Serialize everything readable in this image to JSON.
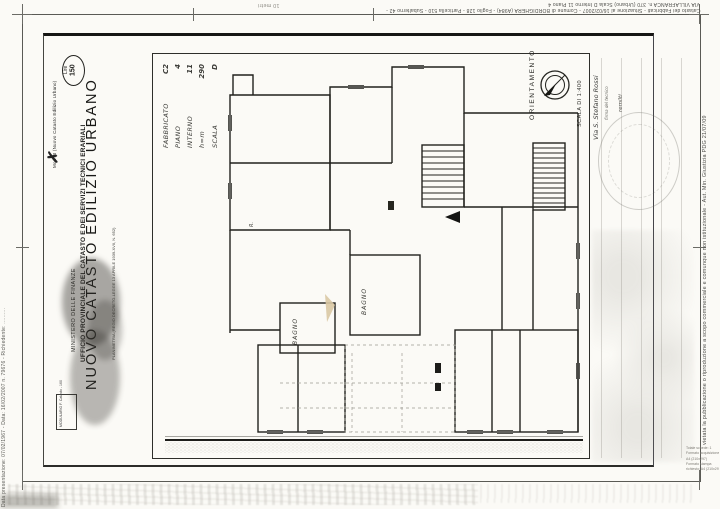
{
  "colors": {
    "paper": "#fbfaf6",
    "ink": "#1d1d1b",
    "faint_gray": "#9a968c",
    "artifact_tan": "#d9c8a4"
  },
  "edge_watermarks": {
    "top_line1": "VIA VILLAFRANCA n. 370 (Urbano) Scala D Interno 11 Piano 4",
    "top_line2": "Catasto dei Fabbricati - Situazione al 16/02/2007 - Comune di BORDIGHERA (A984) - Foglio 128 - Particella 510 - Subalterno 42 -",
    "top_scale_note": "10 metri",
    "left_edge": "Data presentazione: 07/02/1967 - Data: 16/02/2007 n. 79676 - Richiedente: ..........",
    "right_edge": "vietata la pubblicazione o riproduzione a scopo commerciale e comunque non istituzionale - Aut. Min. Giustizia PDG 21/07/09",
    "corner_lines": [
      "Totale schede: 1",
      "Formato acquisizione:",
      "A4 (210x297)",
      "Formato stampa",
      "richiesto: A4 (210x297)"
    ]
  },
  "form": {
    "annotation_x": "✗",
    "mod_note": "Mod. B (Nuovo Catasto Edilizio Urbano)",
    "stamp_currency": "Lire",
    "stamp_value": "150",
    "header_ministry": "MINISTERO DELLE FINANZE",
    "header_office": "UFFICIO PROVINCIALE DEL CATASTO E DEI SERVIZI TECNICI ERARIALI",
    "header_title": "NUOVO CATASTO EDILIZIO URBANO",
    "header_law": "PLANIMETRIA (REGIO DECRETO-LEGGE 13 APRILE 1939-XVII, N. 652)",
    "modulario_line1": "MODULARIO",
    "modulario_line2": "F. Catasto - 160",
    "fields": [
      {
        "label": "FABBRICATO",
        "value": "C2"
      },
      {
        "label": "PIANO",
        "value": "4"
      },
      {
        "label": "INTERNO",
        "value": "11"
      },
      {
        "label": "h=m",
        "value": "290"
      },
      {
        "label": "SCALA",
        "value": "D"
      }
    ],
    "orientation_label": "ORIENTAMENTO",
    "scale_label": "SCALA DI 1:400",
    "handwritten_street": "Via S. Stefano Rossi",
    "handwritten_note": "firma del tecnico",
    "handwritten_side": "remilti"
  },
  "plan": {
    "labels": {
      "bath1": "BAGNO",
      "bath2": "BAGNO",
      "small_room": "R."
    }
  }
}
